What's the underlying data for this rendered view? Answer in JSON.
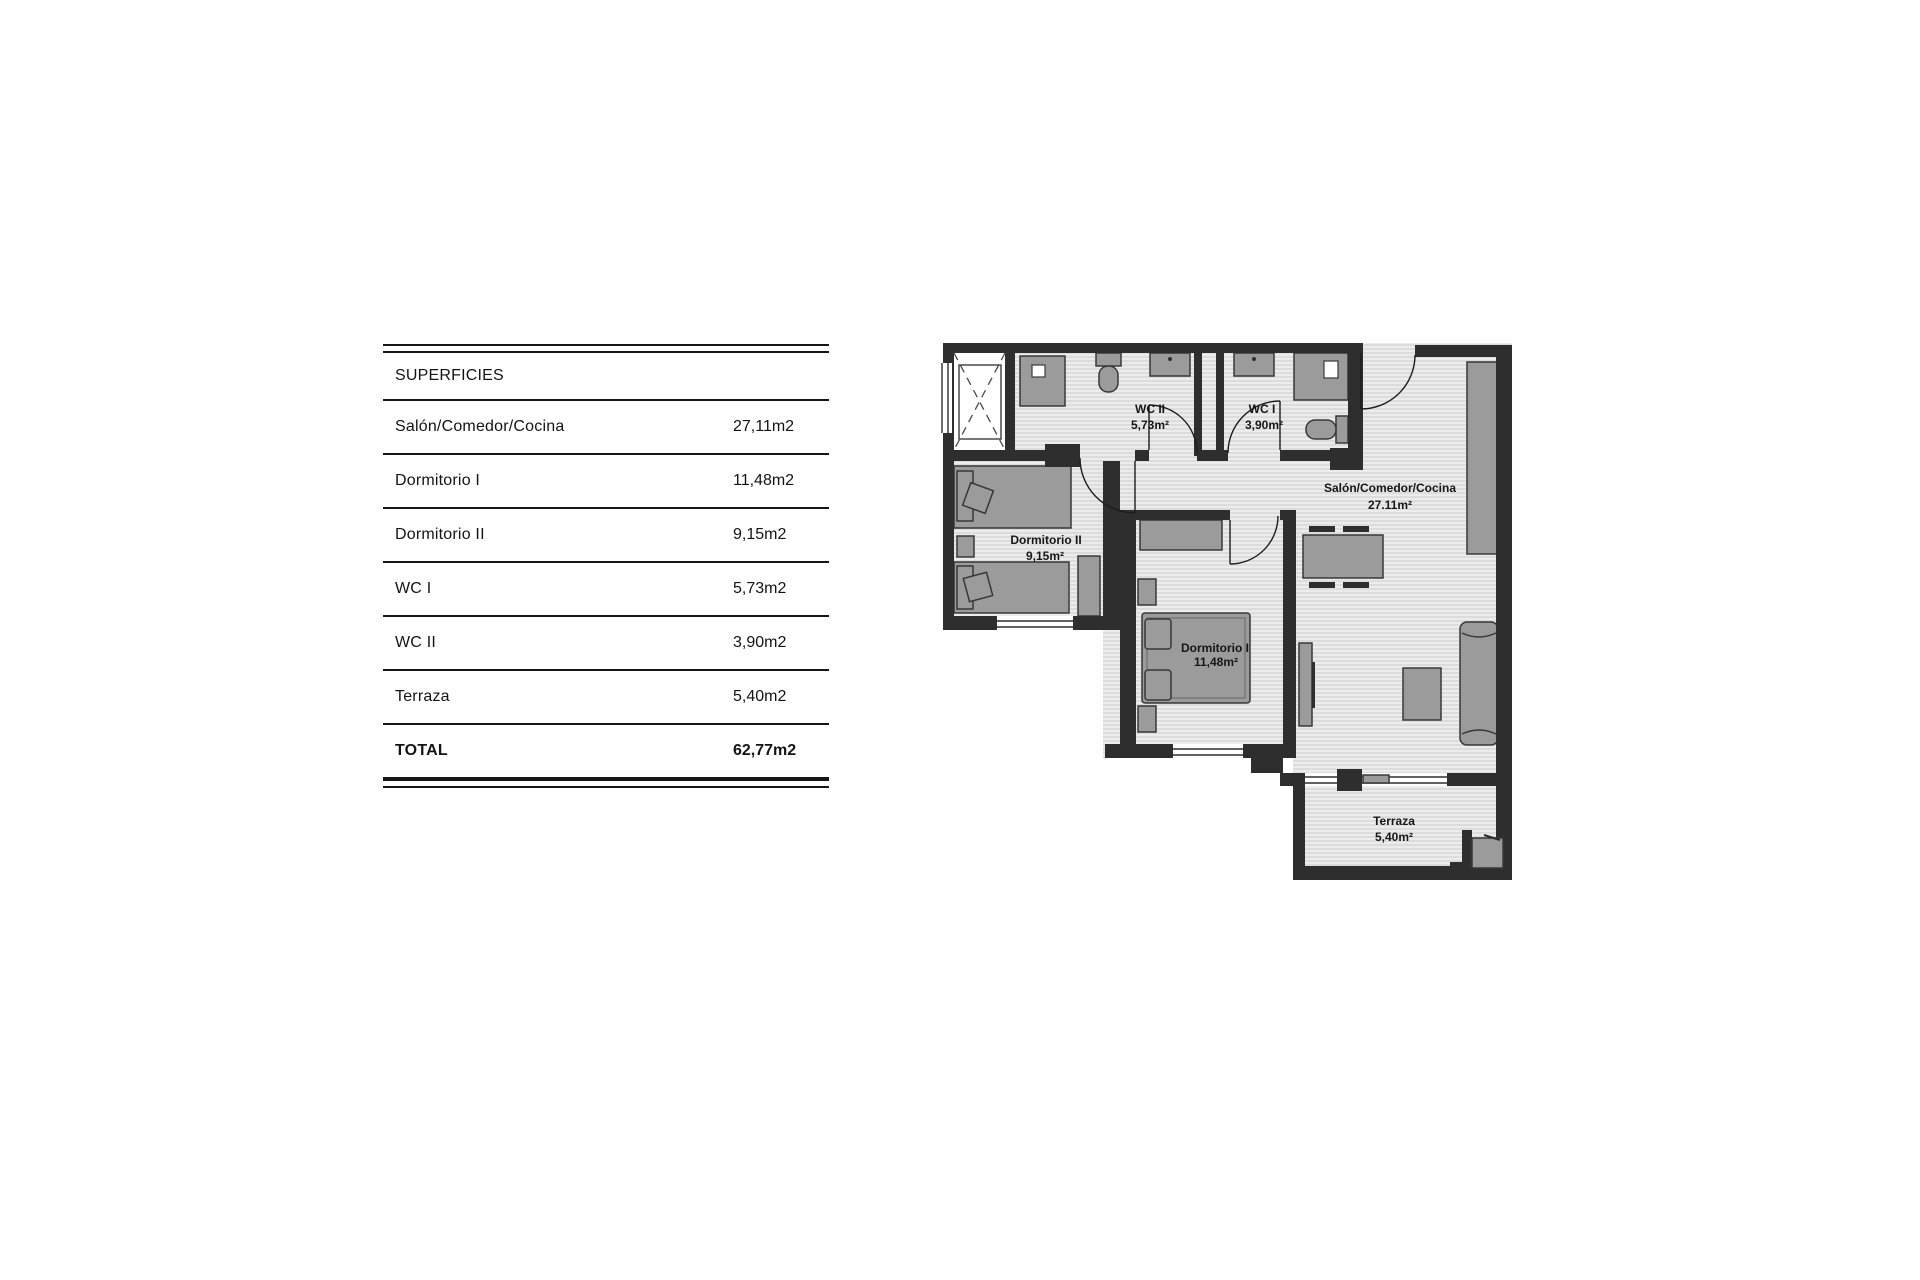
{
  "table": {
    "header": "SUPERFICIES",
    "rows": [
      {
        "label": "Salón/Comedor/Cocina",
        "value": "27,11m2"
      },
      {
        "label": "Dormitorio I",
        "value": "11,48m2"
      },
      {
        "label": "Dormitorio II",
        "value": "9,15m2"
      },
      {
        "label": "WC I",
        "value": "5,73m2"
      },
      {
        "label": "WC II",
        "value": "3,90m2"
      },
      {
        "label": "Terraza",
        "value": "5,40m2"
      }
    ],
    "total": {
      "label": "TOTAL",
      "value": "62,77m2"
    }
  },
  "plan": {
    "rooms": [
      {
        "name": "WC II",
        "area": "5,73m²"
      },
      {
        "name": "WC I",
        "area": "3,90m²"
      },
      {
        "name": "Salón/Comedor/Cocina",
        "area": "27.11m²"
      },
      {
        "name": "Dormitorio II",
        "area": "9,15m²"
      },
      {
        "name": "Dormitorio I",
        "area": "11,48m²"
      },
      {
        "name": "Terraza",
        "area": "5,40m²"
      }
    ],
    "colors": {
      "wall": "#2e2e2e",
      "furniture": "#9b9b9b",
      "floor": "#ececec",
      "hatch_line": "#cdcdcd"
    }
  }
}
